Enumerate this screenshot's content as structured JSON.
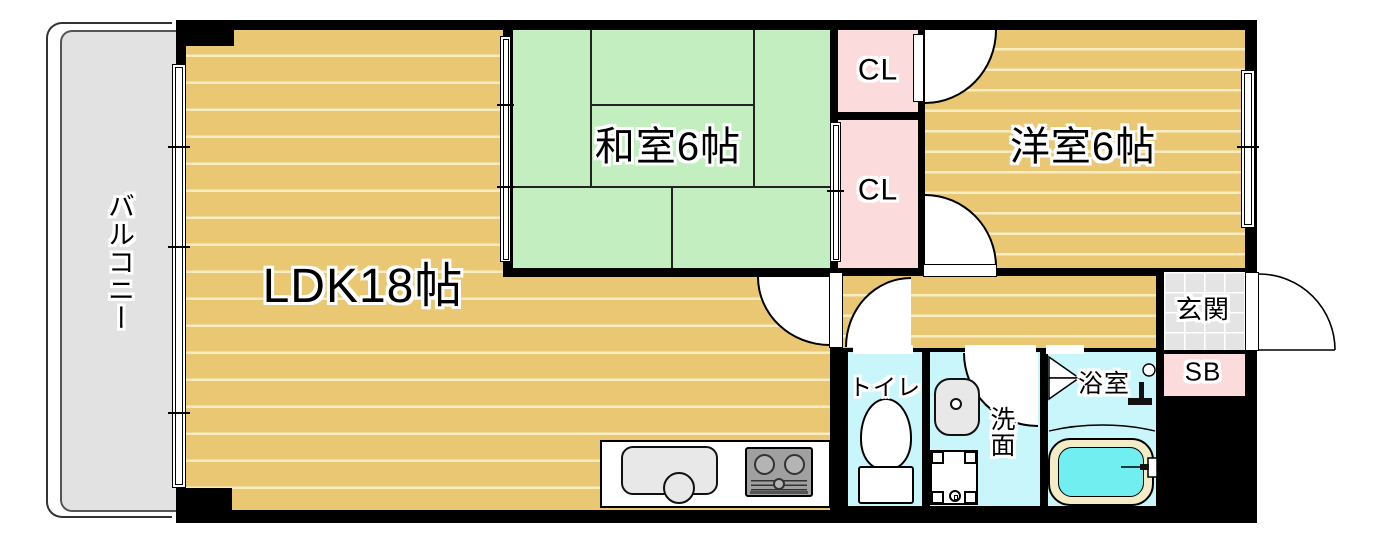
{
  "colors": {
    "wall": "#000000",
    "floor_tan": "#eac873",
    "floor_stripe": "#f8ecc2",
    "tatami_green": "#c2eec0",
    "tatami_line": "#222222",
    "closet_pink": "#fbdbdb",
    "wet_cyan": "#c9f6fa",
    "tile_gray": "#e4e4e4",
    "balcony_gray": "#e2e2e2",
    "tub_rim": "#f3ecc6",
    "tub_water": "#70eef0",
    "fixture_gray": "#e8e8e8",
    "stove_gray": "#a0a0a0"
  },
  "rooms": {
    "balcony": {
      "label": "バルコニー"
    },
    "ldk": {
      "label": "LDK18帖"
    },
    "japanese_room": {
      "label": "和室6帖"
    },
    "western_room": {
      "label": "洋室6帖"
    },
    "closet_upper": {
      "label": "CL"
    },
    "closet_lower": {
      "label": "CL"
    },
    "entrance": {
      "label": "玄関"
    },
    "shoe_box": {
      "label": "SB"
    },
    "toilet": {
      "label": "トイレ"
    },
    "washroom": {
      "label": "洗面"
    },
    "bathroom": {
      "label": "浴室"
    }
  }
}
